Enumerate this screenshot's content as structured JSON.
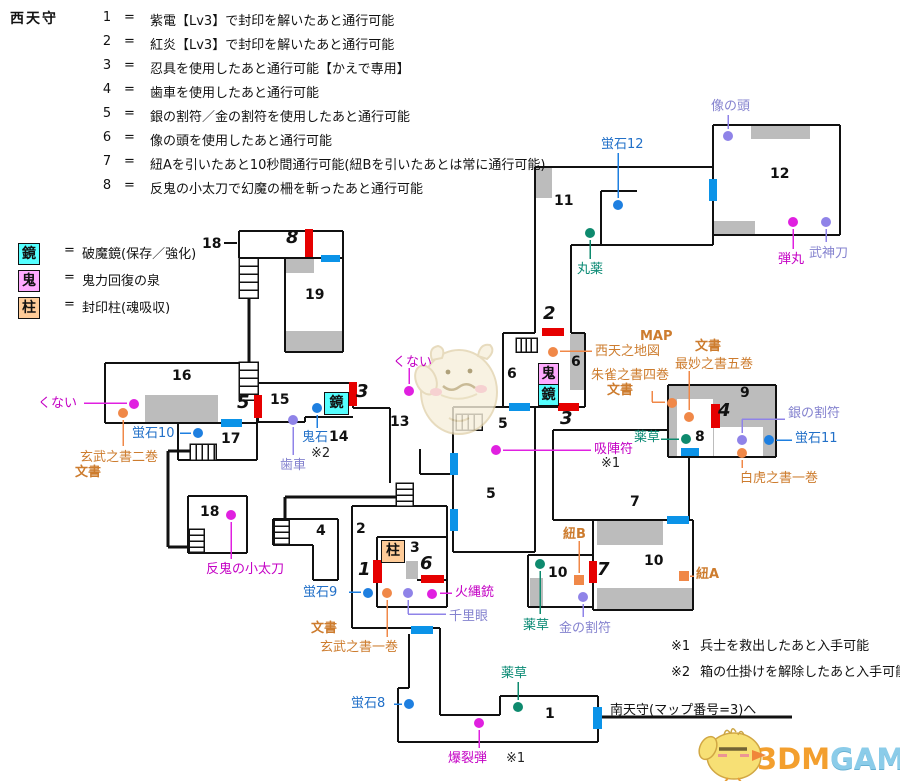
{
  "title": "西天守",
  "legend_separator": "=",
  "legend": [
    {
      "num": "1",
      "text": "紫電【Lv3】で封印を解いたあと通行可能"
    },
    {
      "num": "2",
      "text": "紅炎【Lv3】で封印を解いたあと通行可能"
    },
    {
      "num": "3",
      "text": "忍具を使用したあと通行可能【かえで専用】"
    },
    {
      "num": "4",
      "text": "歯車を使用したあと通行可能"
    },
    {
      "num": "5",
      "text": "銀の割符／金の割符を使用したあと通行可能"
    },
    {
      "num": "6",
      "text": "像の頭を使用したあと通行可能"
    },
    {
      "num": "7",
      "text": "紐Aを引いたあと10秒間通行可能(紐Bを引いたあとは常に通行可能)"
    },
    {
      "num": "8",
      "text": "反鬼の小太刀で幻魔の柵を斬ったあと通行可能"
    }
  ],
  "symbol_legend": [
    {
      "key": "鏡",
      "desc": "破魔鏡(保存／強化)",
      "color": "#55ffff"
    },
    {
      "key": "鬼",
      "desc": "鬼力回復の泉",
      "color": "#ffaaff"
    },
    {
      "key": "柱",
      "desc": "封印柱(魂吸収)",
      "color": "#ffcc99"
    }
  ],
  "notes": [
    {
      "mark": "※1",
      "text": "兵士を救出したあと入手可能"
    },
    {
      "mark": "※2",
      "text": "箱の仕掛けを解除したあと入手可能"
    }
  ],
  "exit": {
    "label": "南天守(マップ番号=3)へ"
  },
  "brand": {
    "part1": "3DM",
    "part2": "GAME"
  },
  "palette": {
    "magenta": "#e020e0",
    "blue": "#1e7fe0",
    "teal": "#0e8a6e",
    "orange": "#f08848",
    "violet": "#8f83e8",
    "red_door": "#e60000",
    "blue_door": "#0b93e8",
    "wall": "#111111",
    "gray_block": "#bcbcbc"
  },
  "map": {
    "room_numbers": [
      {
        "t": "18",
        "x": 202,
        "y": 236
      },
      {
        "t": "19",
        "x": 305,
        "y": 287
      },
      {
        "t": "16",
        "x": 172,
        "y": 368
      },
      {
        "t": "17",
        "x": 221,
        "y": 431
      },
      {
        "t": "18",
        "x": 200,
        "y": 504
      },
      {
        "t": "15",
        "x": 270,
        "y": 392
      },
      {
        "t": "14",
        "x": 329,
        "y": 429
      },
      {
        "t": "13",
        "x": 390,
        "y": 414
      },
      {
        "t": "11",
        "x": 554,
        "y": 193
      },
      {
        "t": "12",
        "x": 770,
        "y": 166
      },
      {
        "t": "6",
        "x": 507,
        "y": 366
      },
      {
        "t": "6",
        "x": 571,
        "y": 354
      },
      {
        "t": "5",
        "x": 498,
        "y": 416
      },
      {
        "t": "5",
        "x": 486,
        "y": 486
      },
      {
        "t": "2",
        "x": 356,
        "y": 521
      },
      {
        "t": "3",
        "x": 410,
        "y": 540
      },
      {
        "t": "4",
        "x": 316,
        "y": 523
      },
      {
        "t": "7",
        "x": 630,
        "y": 494
      },
      {
        "t": "8",
        "x": 695,
        "y": 429
      },
      {
        "t": "9",
        "x": 740,
        "y": 385
      },
      {
        "t": "10",
        "x": 548,
        "y": 565
      },
      {
        "t": "10",
        "x": 644,
        "y": 553
      },
      {
        "t": "1",
        "x": 545,
        "y": 706
      }
    ],
    "gate_numbers": [
      {
        "t": "8",
        "x": 286,
        "y": 227
      },
      {
        "t": "5",
        "x": 237,
        "y": 392
      },
      {
        "t": "3",
        "x": 356,
        "y": 381
      },
      {
        "t": "2",
        "x": 543,
        "y": 303
      },
      {
        "t": "3",
        "x": 560,
        "y": 408
      },
      {
        "t": "1",
        "x": 358,
        "y": 559
      },
      {
        "t": "6",
        "x": 420,
        "y": 553
      },
      {
        "t": "4",
        "x": 718,
        "y": 400
      },
      {
        "t": "7",
        "x": 597,
        "y": 559
      }
    ],
    "symbol_boxes": [
      {
        "ch": "鬼",
        "x": 538,
        "y": 363,
        "w": 19,
        "h": 21,
        "bg": "#ffaaff"
      },
      {
        "ch": "鏡",
        "x": 538,
        "y": 384,
        "w": 19,
        "h": 20,
        "bg": "#55ffff"
      },
      {
        "ch": "鏡",
        "x": 324,
        "y": 392,
        "w": 23,
        "h": 21,
        "bg": "#55ffff"
      },
      {
        "ch": "柱",
        "x": 381,
        "y": 540,
        "w": 22,
        "h": 21,
        "bg": "#ffcc99"
      }
    ],
    "items": [
      {
        "id": "kunai-west",
        "parts": [
          {
            "t": "くない",
            "cls": "magenta",
            "x": 38,
            "y": 396
          }
        ],
        "dot": {
          "x": 134,
          "y": 404,
          "color": "magenta",
          "shape": "circle"
        },
        "lines": [
          [
            84,
            403,
            127,
            403
          ]
        ]
      },
      {
        "id": "genbu-vol2",
        "parts": [
          {
            "t": "玄武之書二巻",
            "cls": "orange",
            "x": 80,
            "y": 450
          },
          {
            "t": "文書",
            "cls": "orange",
            "bold": true,
            "x": 75,
            "y": 465
          }
        ],
        "dot": {
          "x": 123,
          "y": 413,
          "color": "orange",
          "shape": "circle"
        },
        "lines": [
          [
            123,
            420,
            123,
            446
          ]
        ]
      },
      {
        "id": "hotaru10",
        "parts": [
          {
            "t": "蛍石10",
            "cls": "blue",
            "x": 132,
            "y": 426
          }
        ],
        "dot": {
          "x": 198,
          "y": 433,
          "color": "blue",
          "shape": "circle"
        },
        "lines": [
          [
            180,
            433,
            191,
            433
          ]
        ]
      },
      {
        "id": "hangi-kodachi",
        "parts": [
          {
            "t": "反鬼の小太刀",
            "cls": "magenta",
            "x": 206,
            "y": 562
          }
        ],
        "dot": {
          "x": 231,
          "y": 515,
          "color": "magenta",
          "shape": "circle"
        },
        "lines": [
          [
            231,
            522,
            231,
            559
          ]
        ]
      },
      {
        "id": "hotaru9",
        "parts": [
          {
            "t": "蛍石9",
            "cls": "blue",
            "x": 303,
            "y": 585
          }
        ],
        "dot": {
          "x": 368,
          "y": 593,
          "color": "blue",
          "shape": "circle"
        },
        "lines": [
          [
            349,
            592,
            361,
            592
          ]
        ]
      },
      {
        "id": "genbu-vol1",
        "parts": [
          {
            "t": "文書",
            "cls": "orange",
            "bold": true,
            "x": 311,
            "y": 621
          },
          {
            "t": "玄武之書一巻",
            "cls": "orange",
            "x": 320,
            "y": 640
          }
        ],
        "dot": {
          "x": 387,
          "y": 593,
          "color": "orange",
          "shape": "circle"
        },
        "lines": [
          [
            387,
            600,
            387,
            637
          ]
        ]
      },
      {
        "id": "senrigan",
        "parts": [
          {
            "t": "千里眼",
            "cls": "violet",
            "x": 449,
            "y": 609
          }
        ],
        "dot": {
          "x": 408,
          "y": 593,
          "color": "violet",
          "shape": "circle"
        },
        "lines": [
          [
            408,
            600,
            408,
            614
          ],
          [
            408,
            614,
            446,
            614
          ]
        ]
      },
      {
        "id": "hinawaju",
        "parts": [
          {
            "t": "火縄銃",
            "cls": "magenta",
            "x": 455,
            "y": 585
          }
        ],
        "dot": {
          "x": 432,
          "y": 594,
          "color": "magenta",
          "shape": "circle"
        },
        "lines": [
          [
            440,
            593,
            452,
            593
          ]
        ]
      },
      {
        "id": "bakuretsudan",
        "parts": [
          {
            "t": "爆裂弾",
            "cls": "magenta",
            "x": 448,
            "y": 751
          },
          {
            "t": "※1",
            "cls": "black",
            "x": 506,
            "y": 751
          }
        ],
        "dot": {
          "x": 479,
          "y": 723,
          "color": "magenta",
          "shape": "circle"
        },
        "lines": [
          [
            479,
            730,
            479,
            748
          ]
        ]
      },
      {
        "id": "hotaru8",
        "parts": [
          {
            "t": "蛍石8",
            "cls": "blue",
            "x": 351,
            "y": 696
          }
        ],
        "dot": {
          "x": 409,
          "y": 704,
          "color": "blue",
          "shape": "circle"
        },
        "lines": [
          [
            394,
            704,
            402,
            704
          ]
        ]
      },
      {
        "id": "yakusou-room1",
        "parts": [
          {
            "t": "薬草",
            "cls": "teal",
            "x": 501,
            "y": 666
          }
        ],
        "dot": {
          "x": 518,
          "y": 707,
          "color": "teal",
          "shape": "circle"
        },
        "lines": [
          [
            518,
            682,
            518,
            700
          ]
        ]
      },
      {
        "id": "haguruma",
        "parts": [
          {
            "t": "歯車",
            "cls": "violet",
            "x": 280,
            "y": 458
          }
        ],
        "dot": {
          "x": 293,
          "y": 420,
          "color": "violet",
          "shape": "circle"
        },
        "lines": [
          [
            293,
            427,
            293,
            455
          ]
        ]
      },
      {
        "id": "onigoku-ishi",
        "parts": [
          {
            "t": "鬼石",
            "cls": "blue",
            "x": 302,
            "y": 430
          },
          {
            "t": "※2",
            "cls": "black",
            "x": 311,
            "y": 446
          }
        ],
        "dot": {
          "x": 317,
          "y": 408,
          "color": "blue",
          "shape": "circle"
        },
        "lines": [
          [
            317,
            415,
            317,
            428
          ]
        ]
      },
      {
        "id": "kunai-center",
        "parts": [
          {
            "t": "くない",
            "cls": "magenta",
            "x": 393,
            "y": 355
          }
        ],
        "dot": {
          "x": 409,
          "y": 391,
          "color": "magenta",
          "shape": "circle"
        },
        "lines": [
          [
            409,
            368,
            409,
            384
          ]
        ]
      },
      {
        "id": "kyujinfu",
        "parts": [
          {
            "t": "吸陣符",
            "cls": "magenta",
            "x": 594,
            "y": 442
          },
          {
            "t": "※1",
            "cls": "black",
            "x": 601,
            "y": 456
          }
        ],
        "dot": {
          "x": 496,
          "y": 450,
          "color": "magenta",
          "shape": "circle"
        },
        "lines": [
          [
            503,
            450,
            591,
            450
          ]
        ]
      },
      {
        "id": "hotaru12",
        "parts": [
          {
            "t": "蛍石12",
            "cls": "blue",
            "x": 601,
            "y": 137
          }
        ],
        "dot": {
          "x": 618,
          "y": 205,
          "color": "blue",
          "shape": "circle"
        },
        "lines": [
          [
            618,
            153,
            618,
            198
          ]
        ]
      },
      {
        "id": "ganyaku",
        "parts": [
          {
            "t": "丸薬",
            "cls": "teal",
            "x": 577,
            "y": 262
          }
        ],
        "dot": {
          "x": 590,
          "y": 233,
          "color": "teal",
          "shape": "circle"
        },
        "lines": [
          [
            590,
            240,
            590,
            259
          ]
        ]
      },
      {
        "id": "zou-no-atama",
        "parts": [
          {
            "t": "像の頭",
            "cls": "violet",
            "x": 711,
            "y": 99
          }
        ],
        "dot": {
          "x": 728,
          "y": 136,
          "color": "violet",
          "shape": "circle"
        },
        "lines": [
          [
            728,
            115,
            728,
            129
          ]
        ]
      },
      {
        "id": "dangan",
        "parts": [
          {
            "t": "弾丸",
            "cls": "magenta",
            "x": 778,
            "y": 252
          }
        ],
        "dot": {
          "x": 793,
          "y": 222,
          "color": "magenta",
          "shape": "circle"
        },
        "lines": [
          [
            793,
            229,
            793,
            249
          ]
        ]
      },
      {
        "id": "bushintou",
        "parts": [
          {
            "t": "武神刀",
            "cls": "violet",
            "x": 809,
            "y": 246
          }
        ],
        "dot": {
          "x": 826,
          "y": 222,
          "color": "violet",
          "shape": "circle"
        },
        "lines": [
          [
            826,
            229,
            826,
            242
          ]
        ]
      },
      {
        "id": "seiten-map",
        "parts": [
          {
            "t": "MAP",
            "cls": "orange",
            "bold": true,
            "x": 640,
            "y": 329
          },
          {
            "t": "西天之地図",
            "cls": "orange",
            "x": 595,
            "y": 344
          }
        ],
        "dot": {
          "x": 553,
          "y": 352,
          "color": "orange",
          "shape": "circle"
        },
        "lines": [
          [
            560,
            351,
            592,
            351
          ]
        ]
      },
      {
        "id": "saimyou-vol5",
        "parts": [
          {
            "t": "文書",
            "cls": "orange",
            "bold": true,
            "x": 695,
            "y": 339
          },
          {
            "t": "最妙之書五巻",
            "cls": "orange",
            "x": 675,
            "y": 357
          }
        ],
        "dot": {
          "x": 689,
          "y": 417,
          "color": "orange",
          "shape": "circle"
        },
        "lines": [
          [
            689,
            371,
            689,
            410
          ]
        ]
      },
      {
        "id": "suzaku-vol4",
        "parts": [
          {
            "t": "朱雀之書四巻",
            "cls": "orange",
            "x": 591,
            "y": 368
          },
          {
            "t": "文書",
            "cls": "orange",
            "bold": true,
            "x": 607,
            "y": 383
          }
        ],
        "dot": {
          "x": 672,
          "y": 403,
          "color": "orange",
          "shape": "circle"
        },
        "lines": [
          [
            652,
            391,
            652,
            402
          ],
          [
            652,
            402,
            665,
            402
          ]
        ]
      },
      {
        "id": "gin-warifu",
        "parts": [
          {
            "t": "銀の割符",
            "cls": "violet",
            "x": 788,
            "y": 406
          }
        ],
        "dot": {
          "x": 742,
          "y": 440,
          "color": "violet",
          "shape": "circle"
        },
        "lines": [
          [
            742,
            419,
            742,
            433
          ],
          [
            742,
            419,
            785,
            419
          ]
        ]
      },
      {
        "id": "hotaru11",
        "parts": [
          {
            "t": "蛍石11",
            "cls": "blue",
            "x": 795,
            "y": 431
          }
        ],
        "dot": {
          "x": 769,
          "y": 440,
          "color": "blue",
          "shape": "circle"
        },
        "lines": [
          [
            776,
            440,
            792,
            440
          ]
        ]
      },
      {
        "id": "byakko-vol1",
        "parts": [
          {
            "t": "白虎之書一巻",
            "cls": "orange",
            "x": 740,
            "y": 471
          }
        ],
        "dot": {
          "x": 742,
          "y": 453,
          "color": "orange",
          "shape": "circle"
        },
        "lines": [
          [
            742,
            460,
            742,
            468
          ]
        ]
      },
      {
        "id": "yakusou-8",
        "parts": [
          {
            "t": "薬草",
            "cls": "teal",
            "x": 634,
            "y": 430
          }
        ],
        "dot": {
          "x": 686,
          "y": 439,
          "color": "teal",
          "shape": "circle"
        },
        "lines": [
          [
            661,
            439,
            679,
            439
          ]
        ]
      },
      {
        "id": "yakusou-10",
        "parts": [
          {
            "t": "薬草",
            "cls": "teal",
            "x": 523,
            "y": 618
          }
        ],
        "dot": {
          "x": 540,
          "y": 564,
          "color": "teal",
          "shape": "circle"
        },
        "lines": [
          [
            540,
            571,
            540,
            614
          ]
        ]
      },
      {
        "id": "kin-warifu",
        "parts": [
          {
            "t": "金の割符",
            "cls": "violet",
            "x": 559,
            "y": 621
          }
        ],
        "dot": {
          "x": 583,
          "y": 597,
          "color": "violet",
          "shape": "circle"
        },
        "lines": [
          [
            583,
            604,
            583,
            617
          ]
        ]
      },
      {
        "id": "himo-b",
        "parts": [
          {
            "t": "紐B",
            "cls": "orange",
            "bold": true,
            "x": 563,
            "y": 527
          }
        ],
        "dot": {
          "x": 579,
          "y": 580,
          "color": "orange",
          "shape": "square"
        },
        "lines": [
          [
            579,
            541,
            579,
            573
          ]
        ]
      },
      {
        "id": "himo-a",
        "parts": [
          {
            "t": "紐A",
            "cls": "orange",
            "bold": true,
            "x": 696,
            "y": 567
          }
        ],
        "dot": {
          "x": 684,
          "y": 576,
          "color": "orange",
          "shape": "square"
        },
        "lines": [
          [
            690,
            576,
            694,
            576
          ]
        ]
      }
    ]
  }
}
